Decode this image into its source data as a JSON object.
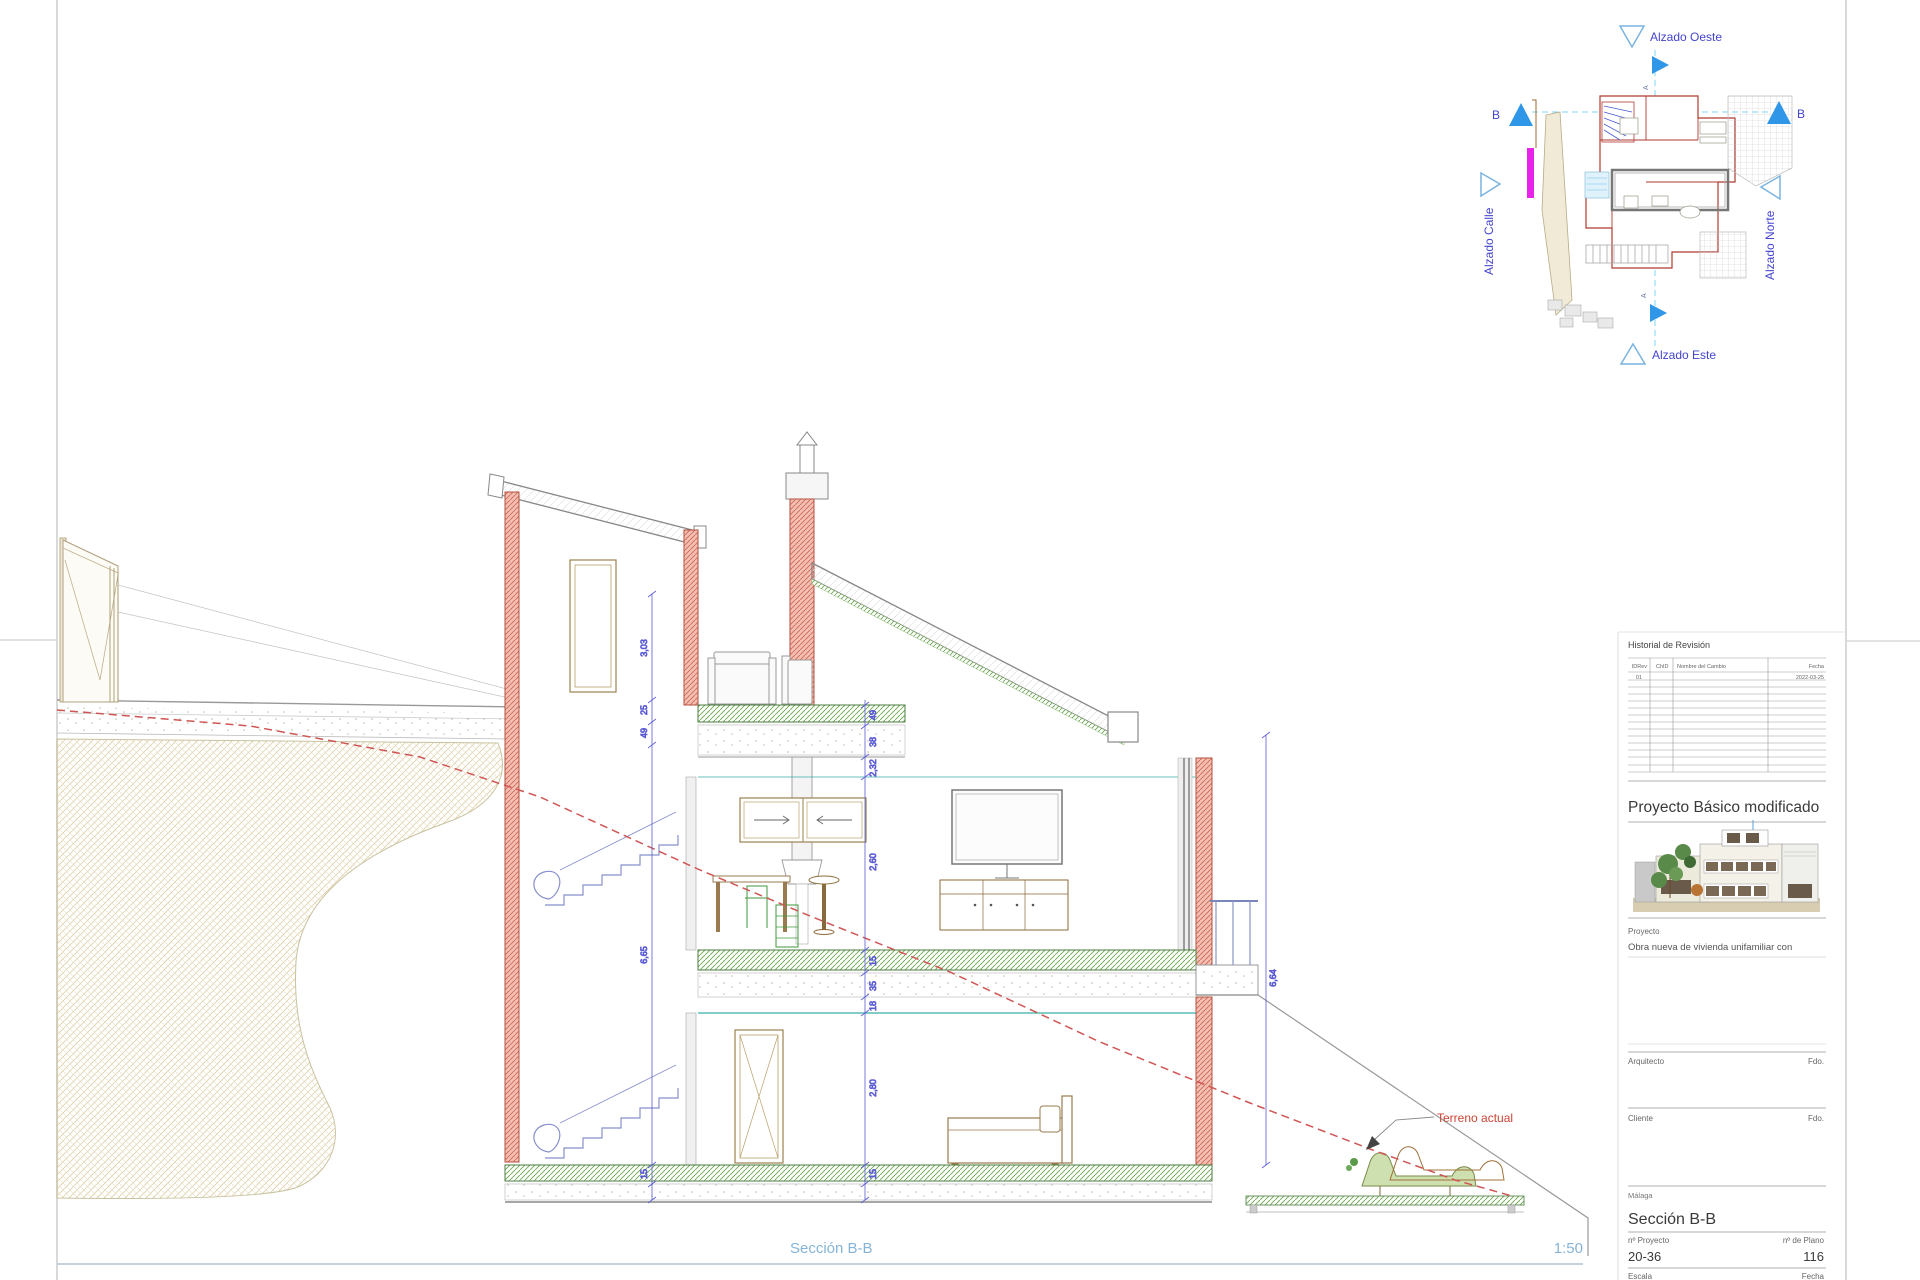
{
  "sheet": {
    "bottom_label": "Sección B-B",
    "bottom_scale": "1:50"
  },
  "key_plan": {
    "labels": {
      "oeste": "Alzado Oeste",
      "calle": "Alzado Calle",
      "norte": "Alzado Norte",
      "este": "Alzado Este",
      "b_left": "B",
      "b_right": "B",
      "a_marker_top": "A",
      "a_marker_bottom": "A"
    },
    "colors": {
      "marker_blue": "#2f96e8",
      "label_blue": "#4444cc",
      "highlight_magenta": "#e822e8"
    }
  },
  "title_block": {
    "revision": {
      "title": "Historial de Revisión",
      "columns": [
        "IDRev",
        "ChID",
        "Nombre del Cambio",
        "Fecha"
      ],
      "row1": {
        "idrev": "01",
        "fecha": "2022-03-25"
      }
    },
    "project_title": "Proyecto Básico modificado",
    "project_label": "Proyecto",
    "project_description": "Obra nueva de vivienda unifamiliar con",
    "architect_label": "Arquitecto",
    "architect_sign": "Fdo.",
    "client_label": "Cliente",
    "client_sign": "Fdo.",
    "location": "Málaga",
    "drawing_name": "Sección B-B",
    "project_no_label": "nº Proyecto",
    "project_no": "20-36",
    "plan_no_label": "nº de Plano",
    "plan_no": "116",
    "scale_label": "Escala",
    "date_label": "Fecha"
  },
  "drawing": {
    "terrain_label": "Terreno actual",
    "dims": {
      "left": [
        "3,03",
        "25",
        "49",
        "6,65",
        "15"
      ],
      "center": [
        "49",
        "38",
        "2,32",
        "2,60",
        "15",
        "35",
        "18",
        "2,80",
        "15"
      ],
      "right": [
        "6,64"
      ]
    },
    "colors": {
      "cut_wall": "#f5b8ac",
      "terrain_line": "#d05555",
      "slab_green": "#6aa84f",
      "stair_blue": "#8890cc"
    }
  }
}
